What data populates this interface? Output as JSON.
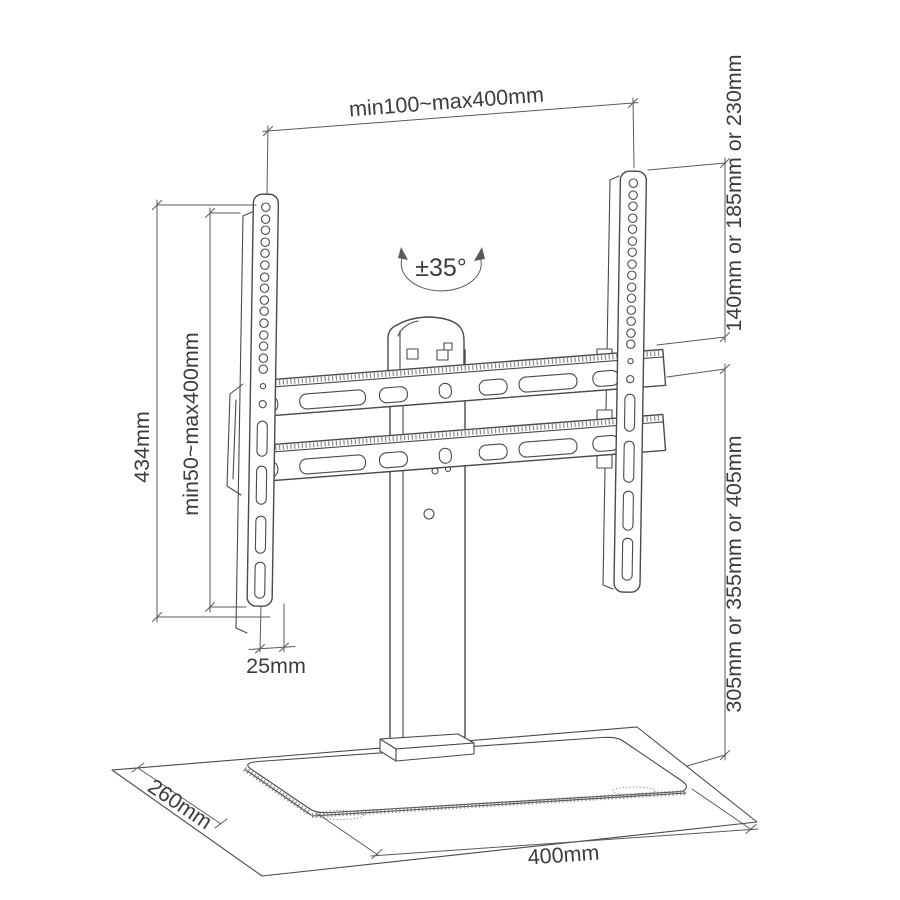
{
  "page": {
    "background": "#ffffff",
    "description": "Technical dimension line drawing of a tabletop TV stand with VESA mount rails, pedestal column and glass base"
  },
  "colors": {
    "drawing_line": "#4a4a4a",
    "dimension_line": "#5a5a5a",
    "label_text": "#3c3c3c"
  },
  "dimensions": {
    "top_span": "min100~max400mm",
    "swivel_angle": "±35°",
    "upper_height_options": "140mm or 185mm or 230mm",
    "total_height": "434mm",
    "vesa_height_range": "min50~max400mm",
    "plate_offset": "25mm",
    "lower_height_options": "305mm or 355mm or 405mm",
    "base_depth": "260mm",
    "base_width": "400mm"
  }
}
